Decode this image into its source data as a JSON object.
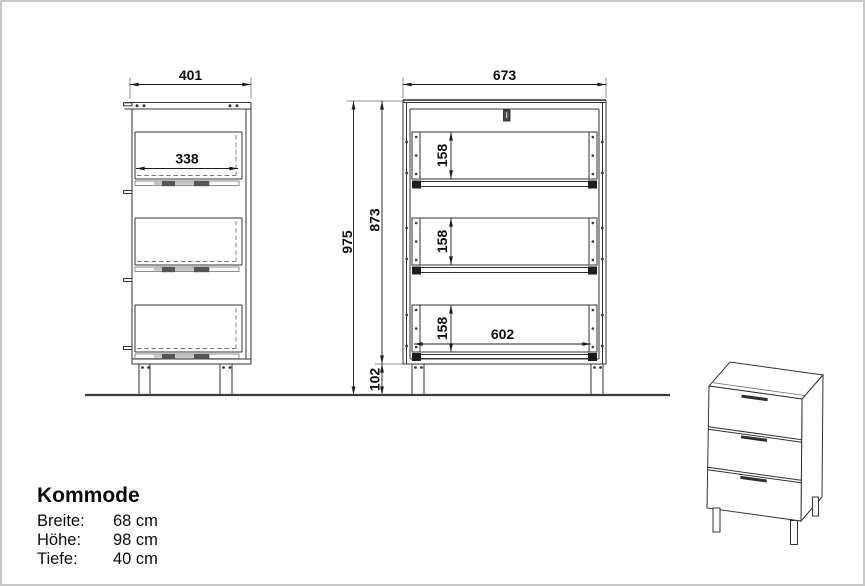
{
  "product": {
    "title": "Kommode",
    "specs": [
      {
        "label": "Breite:",
        "value": "68 cm"
      },
      {
        "label": "Höhe:",
        "value": "98 cm"
      },
      {
        "label": "Tiefe:",
        "value": "40 cm"
      }
    ]
  },
  "dimensions_mm": {
    "side_view": {
      "depth": "401",
      "drawer_depth": "338"
    },
    "front_view": {
      "width": "673",
      "total_height": "975",
      "body_height": "873",
      "leg_height": "102",
      "drawer_heights": [
        "158",
        "158",
        "158"
      ],
      "drawer_inner_width": "602"
    }
  },
  "colors": {
    "background": "#ffffff",
    "page_border": "#c8c8c8",
    "line": "#333333",
    "dimension_text": "#0d0d0d",
    "ground": "#3d3d3d",
    "dark_fitting": "#4a4a4a"
  }
}
